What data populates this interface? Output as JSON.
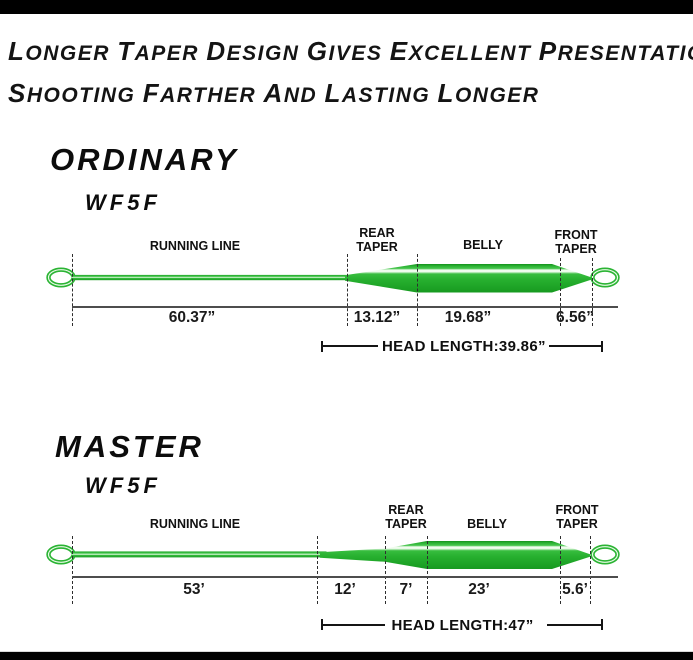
{
  "header": {
    "line1": "Longer taper design gives excellent presentation",
    "line2": "Shooting farther and lasting longer"
  },
  "colors": {
    "line_green": "#2bb434",
    "line_green_dark": "#17951f",
    "line_highlight": "#eefcec",
    "text": "#111111"
  },
  "sections": [
    {
      "id": "ordinary",
      "title": "ORDINARY",
      "model": "WF5F",
      "labels": {
        "running_line": "RUNNING LINE",
        "rear_taper": "REAR TAPER",
        "belly": "BELLY",
        "front_taper": "FRONT TAPER"
      },
      "measurements": {
        "running_line": "60.37”",
        "rear_taper": "13.12”",
        "belly": "19.68”",
        "front_taper": "6.56”"
      },
      "head_length": "HEAD LENGTH:39.86”"
    },
    {
      "id": "master",
      "title": "MASTER",
      "model": "WF5F",
      "labels": {
        "running_line": "RUNNING LINE",
        "rear_taper": "REAR TAPER",
        "belly": "BELLY",
        "front_taper": "FRONT TAPER"
      },
      "measurements": {
        "running_line": "53’",
        "handling_section": "12’",
        "rear_taper": "7’",
        "belly": "23’",
        "front_taper": "5.6’"
      },
      "head_length": "HEAD LENGTH:47”"
    }
  ]
}
